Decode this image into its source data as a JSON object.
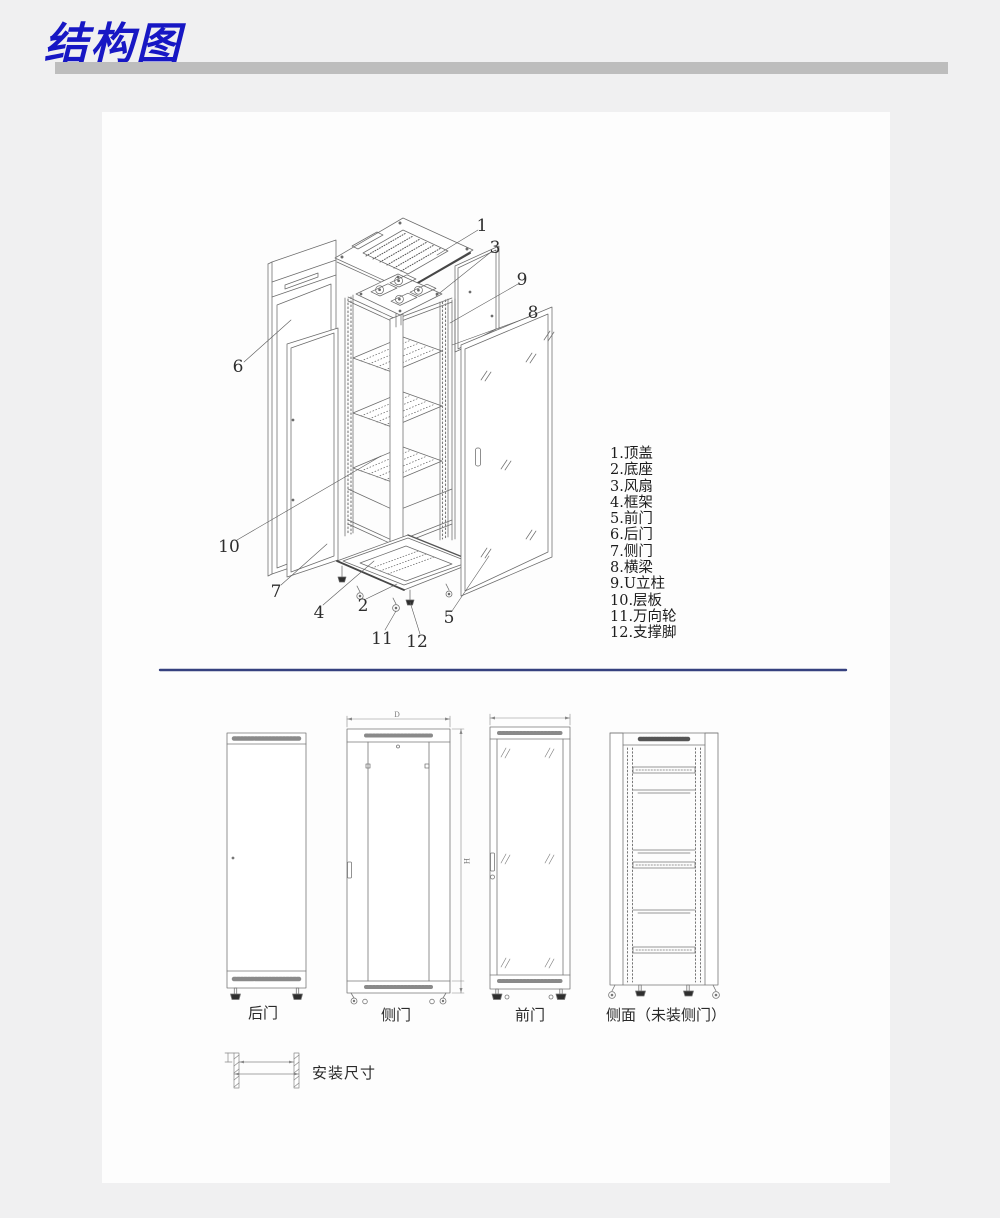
{
  "header": {
    "title": "结构图",
    "title_color": "#1717c4",
    "underline_color": "#bdbdbd"
  },
  "exploded": {
    "callouts": [
      "1",
      "2",
      "3",
      "4",
      "5",
      "6",
      "7",
      "8",
      "9",
      "10",
      "11",
      "12"
    ]
  },
  "legend": {
    "items": [
      "1.顶盖",
      "2.底座",
      "3.风扇",
      "4.框架",
      "5.前门",
      "6.后门",
      "7.侧门",
      "8.横梁",
      "9.U立柱",
      "10.层板",
      "11.万向轮",
      "12.支撑脚"
    ]
  },
  "elevations": {
    "back_door_label": "后门",
    "side_door_label": "侧门",
    "front_door_label": "前门",
    "side_frame_label": "侧面（未装侧门）",
    "dim_depth": "D",
    "dim_height": "H"
  },
  "install": {
    "label": "安装尺寸"
  },
  "colors": {
    "page_bg": "#f0f0f1",
    "panel_bg": "#fdfdfd",
    "divider": "#36417f",
    "line": "#6b6b6b"
  }
}
